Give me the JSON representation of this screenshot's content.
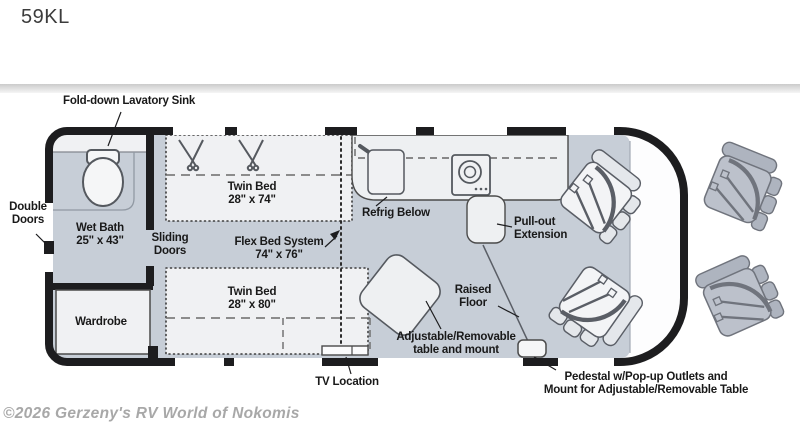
{
  "page": {
    "title": "59KL",
    "watermark": "©2026 Gerzeny's RV World of Nokomis"
  },
  "floorplan": {
    "labels": {
      "fold_down_sink": "Fold-down Lavatory Sink",
      "double_doors": "Double\nDoors",
      "wet_bath": "Wet Bath\n25\" x 43\"",
      "wardrobe": "Wardrobe",
      "sliding_doors": "Sliding\nDoors",
      "twin_bed_top": "Twin Bed\n28\" x 74\"",
      "flex_bed": "Flex Bed System\n74\" x 76\"",
      "twin_bed_bottom": "Twin Bed\n28\" x 80\"",
      "refrig": "Refrig Below",
      "pullout": "Pull-out\nExtension",
      "raised_floor": "Raised\nFloor",
      "table": "Adjustable/Removable\ntable and mount",
      "tv": "TV Location",
      "pedestal": "Pedestal w/Pop-up Outlets and\nMount for Adjustable/Removable Table"
    },
    "colors": {
      "wall": "#1d1d1f",
      "floor": "#c7ced7",
      "furniture_light": "#f0f1f3",
      "seat_gray": "#bcc1cb",
      "line_accent": "#5a5e66"
    }
  }
}
